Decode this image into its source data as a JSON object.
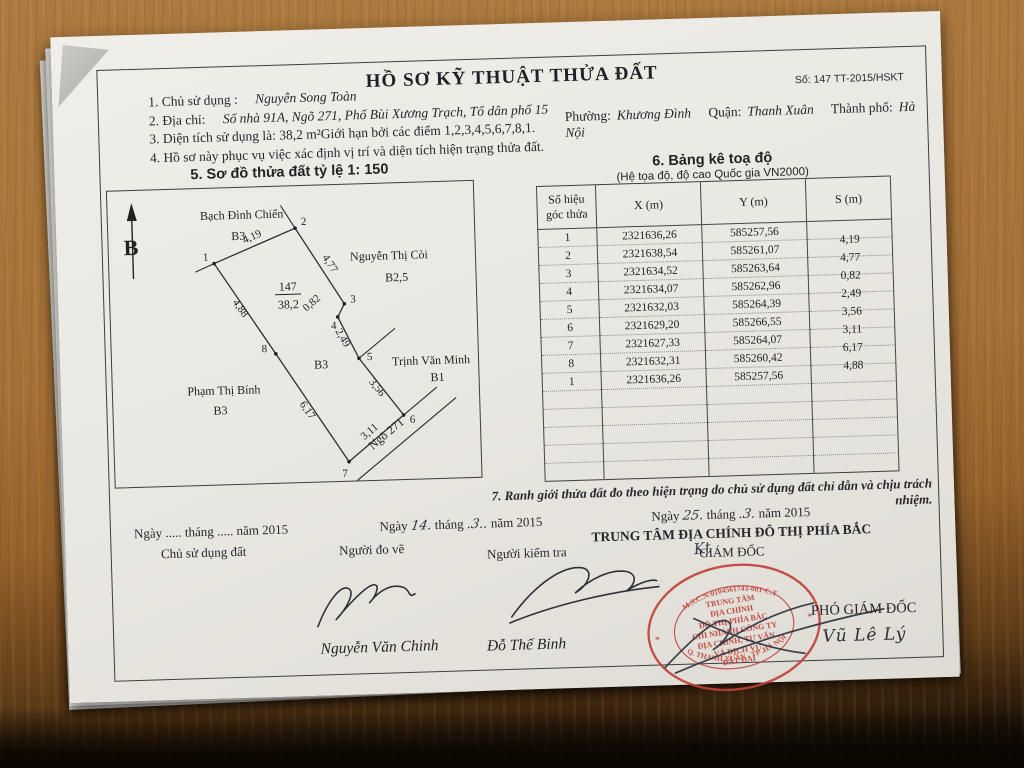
{
  "header": {
    "title": "HỒ SƠ KỸ THUẬT THỬA ĐẤT",
    "doc_no": "Số: 147 TT-2015/HSKT"
  },
  "info": {
    "line1_label": "1. Chủ sử dụng :",
    "line1_value": "Nguyễn Song Toàn",
    "line2_label": "2. Địa chỉ:",
    "line2_value": "Số nhà 91A, Ngõ 271, Phố Bùi Xương Trạch, Tổ dân phố 15",
    "ward_label": "Phường:",
    "ward_value": "Khương Đình",
    "district_label": "Quận:",
    "district_value": "Thanh Xuân",
    "city_label": "Thành phố:",
    "city_value": "Hà Nội",
    "line3": "3. Diện tích sử dụng là: 38,2 m²Giới hạn bởi các điểm 1,2,3,4,5,6,7,8,1.",
    "line4": "4. Hồ sơ này phục vụ việc xác định vị trí và diện tích hiện trạng thửa đất."
  },
  "diagram": {
    "section_title": "5. Sơ đồ thửa đất tỷ lệ 1: 150",
    "north_label": "B",
    "parcel_number": "147",
    "parcel_area": "38,2",
    "inner_grade": "B3",
    "road_label": "Ngõ 271",
    "neighbors": {
      "top": {
        "name": "Bạch Đình Chiến",
        "grade": "B3"
      },
      "right": {
        "name": "Nguyễn Thị Còi",
        "grade": "B2,5"
      },
      "mid_right": {
        "name": "Trịnh Văn Minh",
        "grade": "B1"
      },
      "left": {
        "name": "Phạm Thị Bính",
        "grade": "B3"
      }
    },
    "points": {
      "p1": "1",
      "p2": "2",
      "p3": "3",
      "p4": "4",
      "p5": "5",
      "p6": "6",
      "p7": "7",
      "p8": "8"
    },
    "edges": {
      "e12": "4,19",
      "e23": "4,77",
      "e34": "0,82",
      "e45": "2,49",
      "e56": "3,56",
      "e67": "3,11",
      "e78": "6,17",
      "e81": "4,88"
    }
  },
  "table": {
    "section_title": "6. Bảng kê toạ độ",
    "subtitle": "(Hệ tọa độ, độ cao Quốc gia VN2000)",
    "columns": {
      "c1a": "Số hiệu",
      "c1b": "góc thửa",
      "c2": "X (m)",
      "c3": "Y (m)",
      "c4": "S (m)"
    },
    "rows": [
      {
        "no": "1",
        "x": "2321636,26",
        "y": "585257,56",
        "s": ""
      },
      {
        "no": "2",
        "x": "2321638,54",
        "y": "585261,07",
        "s": "4,19"
      },
      {
        "no": "3",
        "x": "2321634,52",
        "y": "585263,64",
        "s": "4,77"
      },
      {
        "no": "4",
        "x": "2321634,07",
        "y": "585262,96",
        "s": "0,82"
      },
      {
        "no": "5",
        "x": "2321632,03",
        "y": "585264,39",
        "s": "2,49"
      },
      {
        "no": "6",
        "x": "2321629,20",
        "y": "585266,55",
        "s": "3,56"
      },
      {
        "no": "7",
        "x": "2321627,33",
        "y": "585264,07",
        "s": "3,11"
      },
      {
        "no": "8",
        "x": "2321632,31",
        "y": "585260,42",
        "s": "6,17"
      },
      {
        "no": "1",
        "x": "2321636,26",
        "y": "585257,56",
        "s": "4,88"
      }
    ]
  },
  "note7": "7. Ranh giới thửa đất đo theo hiện trạng do chủ sử dụng đất chỉ dẫn và chịu trách nhiệm.",
  "footer": {
    "left": {
      "date": "Ngày ..... tháng ..... năm 2015",
      "role": "Chủ sử dụng đất"
    },
    "mid": {
      "p1": "Ngày",
      "day": "14.",
      "p2": "tháng",
      "month": ".3..",
      "p3": "năm 2015",
      "role1": "Người đo vẽ",
      "role2": "Người kiểm tra",
      "signer1": "Nguyễn Văn Chinh",
      "signer2": "Đỗ Thế Binh"
    },
    "right": {
      "p1": "Ngày",
      "day": "25.",
      "p2": "tháng",
      "month": ".3.",
      "p3": "năm 2015",
      "org": "TRUNG TÂM ĐỊA CHÍNH ĐÔ THỊ PHÍA BẮC",
      "kt": "Kt",
      "director": "GIÁM ĐỐC",
      "deputy_role": "PHÓ GIÁM ĐỐC",
      "deputy_name": "Vũ Lê Lý"
    }
  },
  "stamp": {
    "color": "#bf4038",
    "ring_top": "M.S.C.N:0104561743-001-C.T",
    "ring_bottom": "Q. THANH XUÂN - TP .HÀ NỘI",
    "star_left": "*",
    "star_right": "*",
    "center_lines": [
      "TRUNG TÂM",
      "ĐỊA CHÍNH",
      "ĐÔ THỊ PHÍA BẮC",
      "CHI NHÁNH CÔNG TY",
      "ĐỊA CHÍNH, TƯ VẤN",
      "VÀ DỊCH VỤ",
      "ĐẤT ĐAI"
    ]
  }
}
